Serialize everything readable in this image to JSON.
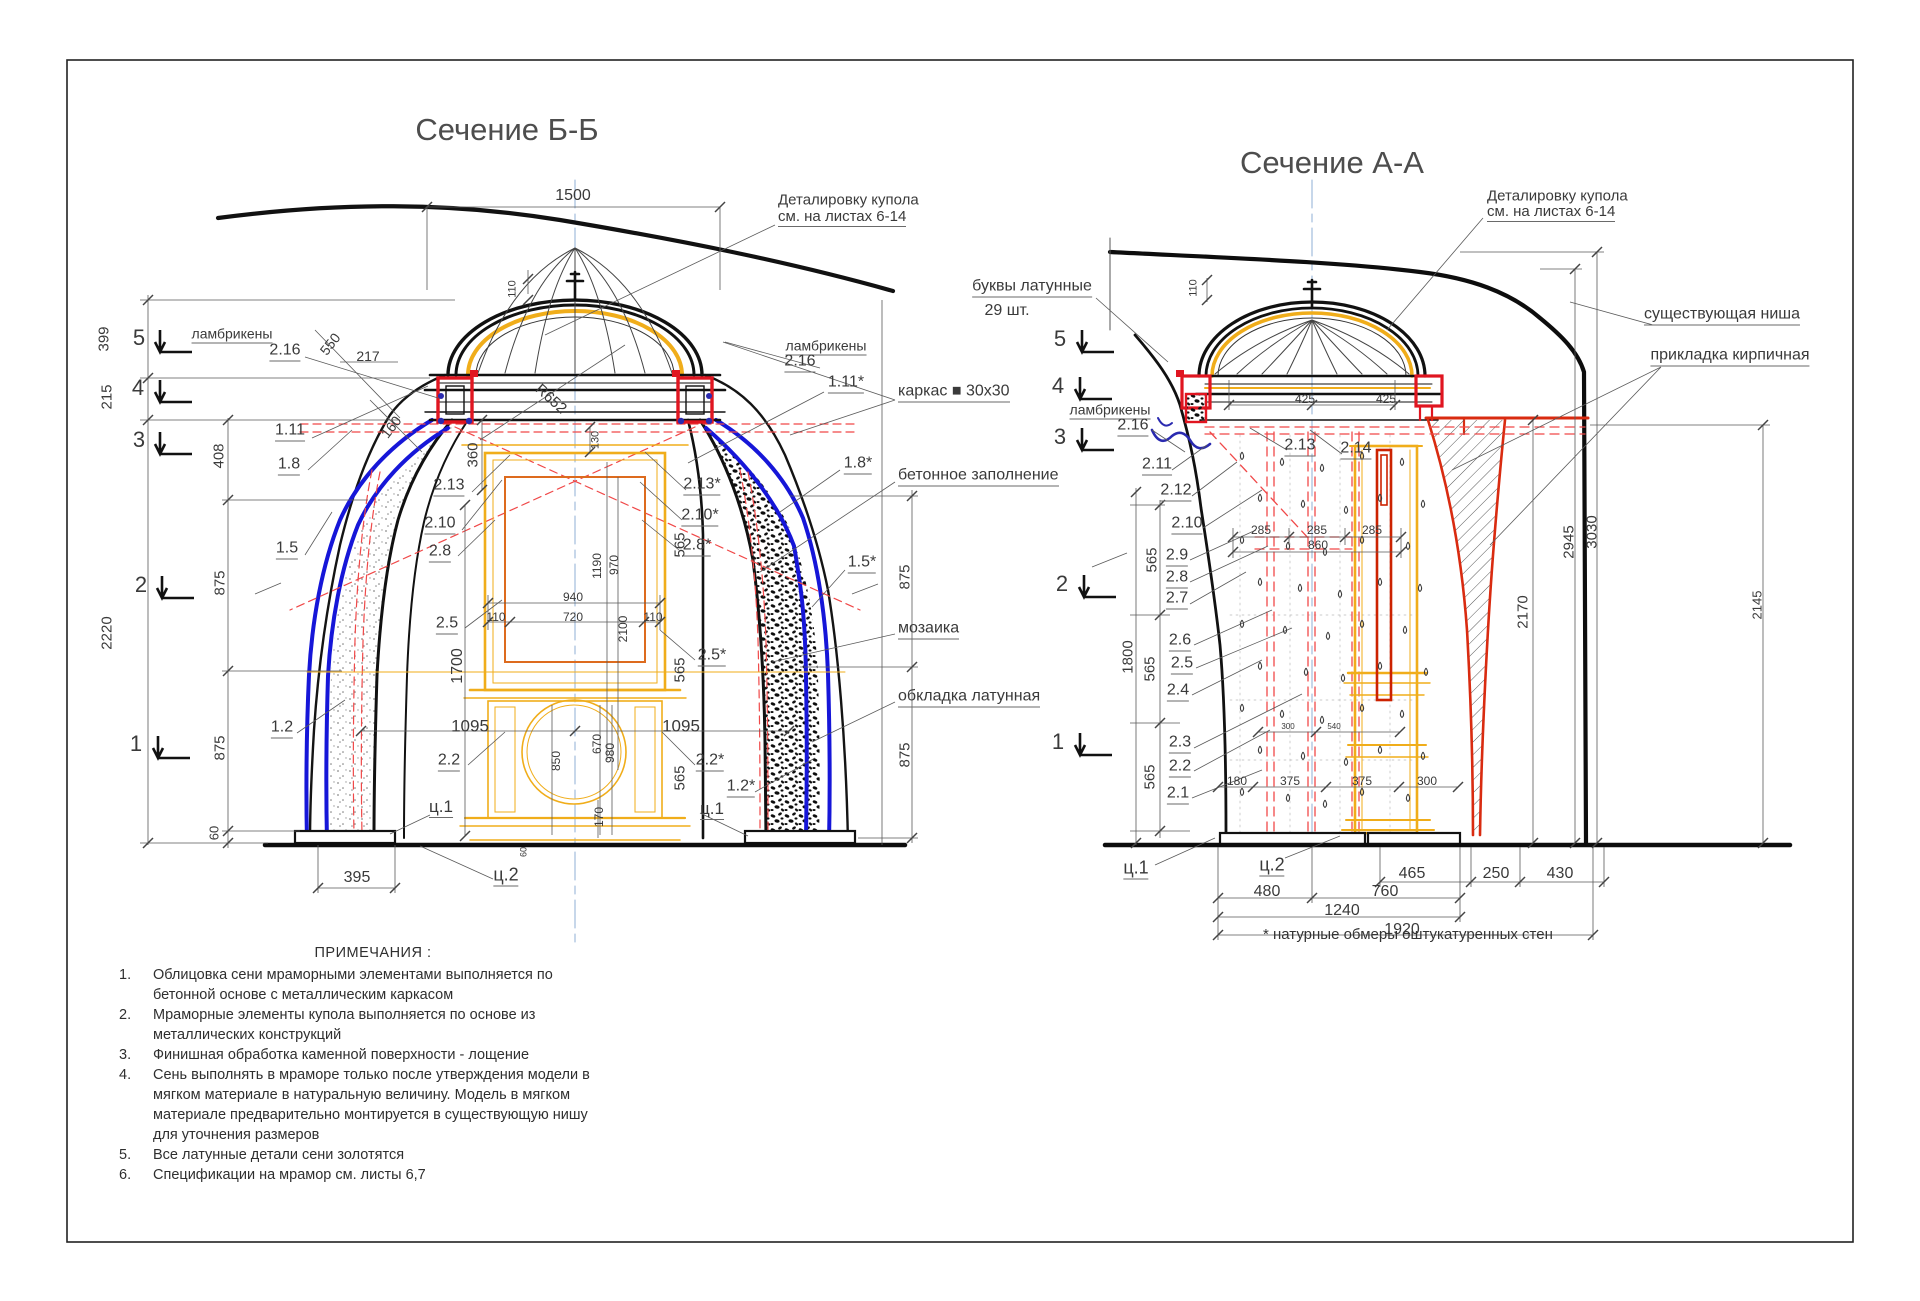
{
  "sheet": {
    "left_title": "Сечение Б-Б",
    "right_title": "Сечение А-А",
    "footnote": "* натурные обмеры оштукатуренных стен"
  },
  "colors": {
    "line": "#1b1b1b",
    "dim_line": "#555555",
    "text": "#3a3a3a",
    "frame_blue": "#1616d8",
    "detail_red": "#e01520",
    "dash_red": "#f04848",
    "gold": "#f0ad1a",
    "orange": "#dd6b1e",
    "brick_red": "#d92b10",
    "axis_blue": "#8fafd6"
  },
  "left_section": {
    "labels": [
      {
        "t": "1500",
        "x": 573,
        "y": 196,
        "s": 16
      },
      {
        "t": "Деталировку купола",
        "x": 778,
        "y": 200,
        "s": 15,
        "a": "start",
        "n": "callout-dome-detail"
      },
      {
        "t": "см. на листах 6-14",
        "x": 778,
        "y": 218,
        "s": 15,
        "a": "start",
        "u": true,
        "n": "callout-dome-detail"
      },
      {
        "t": "110",
        "x": 513,
        "y": 289,
        "r": -90,
        "s": 11
      },
      {
        "t": "ламбрикены",
        "x": 232,
        "y": 335,
        "s": 14,
        "u": true,
        "n": "callout-lambrequins"
      },
      {
        "t": "2.16",
        "x": 285,
        "y": 352,
        "s": 16,
        "u": true
      },
      {
        "t": "550",
        "x": 330,
        "y": 344,
        "r": -52,
        "s": 14
      },
      {
        "t": "217",
        "x": 368,
        "y": 356,
        "s": 14
      },
      {
        "t": "160",
        "x": 391,
        "y": 427,
        "r": -52,
        "s": 14
      },
      {
        "t": "5",
        "x": 139,
        "y": 338,
        "s": 22,
        "n": "level-mark"
      },
      {
        "t": "4",
        "x": 138,
        "y": 388,
        "s": 22,
        "n": "level-mark"
      },
      {
        "t": "3",
        "x": 139,
        "y": 440,
        "s": 22,
        "n": "level-mark"
      },
      {
        "t": "2",
        "x": 141,
        "y": 585,
        "s": 22,
        "n": "level-mark"
      },
      {
        "t": "1",
        "x": 136,
        "y": 744,
        "s": 22,
        "n": "level-mark"
      },
      {
        "t": "399",
        "x": 104,
        "y": 339,
        "r": -90,
        "s": 15
      },
      {
        "t": "215",
        "x": 107,
        "y": 397,
        "r": -90,
        "s": 15
      },
      {
        "t": "2220",
        "x": 107,
        "y": 633,
        "r": -90,
        "s": 15
      },
      {
        "t": "408",
        "x": 219,
        "y": 456,
        "r": -90,
        "s": 15
      },
      {
        "t": "875",
        "x": 220,
        "y": 583,
        "r": -90,
        "s": 15
      },
      {
        "t": "875",
        "x": 220,
        "y": 748,
        "r": -90,
        "s": 15
      },
      {
        "t": "60",
        "x": 214,
        "y": 833,
        "r": -90,
        "s": 13
      },
      {
        "t": "1.11",
        "x": 290,
        "y": 432,
        "s": 16,
        "u": true
      },
      {
        "t": "1.8",
        "x": 289,
        "y": 466,
        "s": 16,
        "u": true
      },
      {
        "t": "1.5",
        "x": 287,
        "y": 550,
        "s": 16,
        "u": true
      },
      {
        "t": "1.2",
        "x": 282,
        "y": 729,
        "s": 16,
        "u": true
      },
      {
        "t": "2.13",
        "x": 449,
        "y": 487,
        "s": 16,
        "u": true
      },
      {
        "t": "2.10",
        "x": 440,
        "y": 525,
        "s": 16,
        "u": true
      },
      {
        "t": "2.8",
        "x": 440,
        "y": 553,
        "s": 16,
        "u": true
      },
      {
        "t": "2.5",
        "x": 447,
        "y": 625,
        "s": 16,
        "u": true
      },
      {
        "t": "2.2",
        "x": 449,
        "y": 762,
        "s": 16,
        "u": true
      },
      {
        "t": "ц.1",
        "x": 441,
        "y": 808,
        "s": 17,
        "u": true
      },
      {
        "t": "ц.2",
        "x": 506,
        "y": 876,
        "s": 18,
        "u": true
      },
      {
        "t": "395",
        "x": 357,
        "y": 878,
        "s": 16
      },
      {
        "t": "R652",
        "x": 551,
        "y": 399,
        "r": 42,
        "s": 15
      },
      {
        "t": "360",
        "x": 473,
        "y": 455,
        "r": -90,
        "s": 15
      },
      {
        "t": "130",
        "x": 596,
        "y": 440,
        "r": -90,
        "s": 11
      },
      {
        "t": "1190",
        "x": 597,
        "y": 566,
        "r": -90,
        "s": 12
      },
      {
        "t": "970",
        "x": 614,
        "y": 565,
        "r": -90,
        "s": 12
      },
      {
        "t": "2100",
        "x": 623,
        "y": 629,
        "r": -90,
        "s": 12
      },
      {
        "t": "940",
        "x": 573,
        "y": 597,
        "s": 12
      },
      {
        "t": "110",
        "x": 496,
        "y": 617,
        "s": 12
      },
      {
        "t": "720",
        "x": 573,
        "y": 617,
        "s": 12
      },
      {
        "t": "110",
        "x": 653,
        "y": 617,
        "s": 12
      },
      {
        "t": "1700",
        "x": 458,
        "y": 666,
        "r": -90,
        "s": 16
      },
      {
        "t": "1095",
        "x": 470,
        "y": 726,
        "s": 17
      },
      {
        "t": "1095",
        "x": 681,
        "y": 726,
        "s": 17
      },
      {
        "t": "850",
        "x": 556,
        "y": 761,
        "r": -90,
        "s": 12
      },
      {
        "t": "670",
        "x": 597,
        "y": 744,
        "r": -90,
        "s": 12
      },
      {
        "t": "980",
        "x": 610,
        "y": 753,
        "r": -90,
        "s": 12
      },
      {
        "t": "170",
        "x": 599,
        "y": 817,
        "r": -90,
        "s": 12
      },
      {
        "t": "60",
        "x": 524,
        "y": 852,
        "r": -90,
        "s": 9
      },
      {
        "t": "565",
        "x": 680,
        "y": 545,
        "r": -90,
        "s": 15
      },
      {
        "t": "565",
        "x": 680,
        "y": 670,
        "r": -90,
        "s": 15
      },
      {
        "t": "565",
        "x": 680,
        "y": 778,
        "r": -90,
        "s": 15
      },
      {
        "t": "2.13*",
        "x": 702,
        "y": 486,
        "s": 16,
        "u": true
      },
      {
        "t": "2.10*",
        "x": 700,
        "y": 517,
        "s": 16,
        "u": true
      },
      {
        "t": "2.8*",
        "x": 697,
        "y": 547,
        "s": 16,
        "u": true
      },
      {
        "t": "2.5*",
        "x": 712,
        "y": 657,
        "s": 16,
        "u": true
      },
      {
        "t": "2.2*",
        "x": 710,
        "y": 762,
        "s": 16,
        "u": true
      },
      {
        "t": "ц.1",
        "x": 712,
        "y": 810,
        "s": 17,
        "u": true
      },
      {
        "t": "1.2*",
        "x": 741,
        "y": 788,
        "s": 16,
        "u": true
      },
      {
        "t": "ламбрикены",
        "x": 826,
        "y": 347,
        "s": 14,
        "u": true,
        "n": "callout-lambrequins"
      },
      {
        "t": "2.16",
        "x": 800,
        "y": 363,
        "s": 16,
        "u": true
      },
      {
        "t": "1.11*",
        "x": 846,
        "y": 384,
        "s": 16,
        "u": true
      },
      {
        "t": "1.8*",
        "x": 858,
        "y": 465,
        "s": 16,
        "u": true
      },
      {
        "t": "1.5*",
        "x": 862,
        "y": 564,
        "s": 16,
        "u": true
      },
      {
        "t": "каркас  ■  30х30",
        "x": 898,
        "y": 393,
        "s": 16,
        "a": "start",
        "u": true,
        "n": "callout-frame"
      },
      {
        "t": "бетонное заполнение",
        "x": 898,
        "y": 477,
        "s": 16,
        "a": "start",
        "u": true,
        "n": "callout-concrete"
      },
      {
        "t": "мозаика",
        "x": 898,
        "y": 630,
        "s": 16,
        "a": "start",
        "u": true,
        "n": "callout-mosaic"
      },
      {
        "t": "обкладка латунная",
        "x": 898,
        "y": 698,
        "s": 16,
        "a": "start",
        "u": true,
        "n": "callout-brass"
      },
      {
        "t": "875",
        "x": 905,
        "y": 577,
        "r": -90,
        "s": 15
      },
      {
        "t": "875",
        "x": 905,
        "y": 755,
        "r": -90,
        "s": 15
      }
    ]
  },
  "right_section": {
    "labels": [
      {
        "t": "Деталировку купола",
        "x": 1487,
        "y": 196,
        "s": 15,
        "a": "start",
        "n": "callout-dome-detail"
      },
      {
        "t": "см. на листах 6-14",
        "x": 1487,
        "y": 213,
        "s": 15,
        "a": "start",
        "u": true,
        "n": "callout-dome-detail"
      },
      {
        "t": "буквы латунные",
        "x": 1032,
        "y": 288,
        "s": 16,
        "u": true,
        "n": "callout-brass-letters"
      },
      {
        "t": "29 шт.",
        "x": 1007,
        "y": 311,
        "s": 16,
        "n": "callout-brass-letters-qty"
      },
      {
        "t": "110",
        "x": 1194,
        "y": 288,
        "r": -90,
        "s": 11
      },
      {
        "t": "425",
        "x": 1305,
        "y": 399,
        "s": 12
      },
      {
        "t": "425",
        "x": 1386,
        "y": 399,
        "s": 12
      },
      {
        "t": "существующая ниша",
        "x": 1722,
        "y": 316,
        "s": 16,
        "u": true,
        "n": "callout-existing-niche"
      },
      {
        "t": "прикладка кирпичная",
        "x": 1730,
        "y": 357,
        "s": 16,
        "u": true,
        "n": "callout-brickwork"
      },
      {
        "t": "5",
        "x": 1060,
        "y": 339,
        "s": 22,
        "n": "level-mark"
      },
      {
        "t": "4",
        "x": 1058,
        "y": 386,
        "s": 22,
        "n": "level-mark"
      },
      {
        "t": "3",
        "x": 1060,
        "y": 437,
        "s": 22,
        "n": "level-mark"
      },
      {
        "t": "2",
        "x": 1062,
        "y": 584,
        "s": 22,
        "n": "level-mark"
      },
      {
        "t": "1",
        "x": 1058,
        "y": 742,
        "s": 22,
        "n": "level-mark"
      },
      {
        "t": "ламбрикены",
        "x": 1110,
        "y": 411,
        "s": 14,
        "u": true,
        "n": "callout-lambrequins"
      },
      {
        "t": "2.16",
        "x": 1133,
        "y": 427,
        "s": 16,
        "u": true
      },
      {
        "t": "2.11",
        "x": 1157,
        "y": 466,
        "s": 16,
        "u": true
      },
      {
        "t": "2.12",
        "x": 1176,
        "y": 492,
        "s": 16,
        "u": true
      },
      {
        "t": "2.10",
        "x": 1187,
        "y": 525,
        "s": 16,
        "u": true
      },
      {
        "t": "2.9",
        "x": 1177,
        "y": 557,
        "s": 16,
        "u": true
      },
      {
        "t": "2.8",
        "x": 1177,
        "y": 579,
        "s": 16,
        "u": true
      },
      {
        "t": "2.7",
        "x": 1177,
        "y": 600,
        "s": 16,
        "u": true
      },
      {
        "t": "2.6",
        "x": 1180,
        "y": 642,
        "s": 16,
        "u": true
      },
      {
        "t": "2.5",
        "x": 1182,
        "y": 665,
        "s": 16,
        "u": true
      },
      {
        "t": "2.4",
        "x": 1178,
        "y": 692,
        "s": 16,
        "u": true
      },
      {
        "t": "2.3",
        "x": 1180,
        "y": 744,
        "s": 16,
        "u": true
      },
      {
        "t": "2.2",
        "x": 1180,
        "y": 768,
        "s": 16,
        "u": true
      },
      {
        "t": "2.1",
        "x": 1178,
        "y": 795,
        "s": 16,
        "u": true
      },
      {
        "t": "2.13",
        "x": 1300,
        "y": 447,
        "s": 16,
        "u": true
      },
      {
        "t": "2.14",
        "x": 1356,
        "y": 450,
        "s": 16,
        "u": true
      },
      {
        "t": "285",
        "x": 1261,
        "y": 530,
        "s": 12
      },
      {
        "t": "285",
        "x": 1317,
        "y": 530,
        "s": 12
      },
      {
        "t": "285",
        "x": 1372,
        "y": 530,
        "s": 12
      },
      {
        "t": "860",
        "x": 1318,
        "y": 545,
        "s": 12
      },
      {
        "t": "565",
        "x": 1152,
        "y": 560,
        "r": -90,
        "s": 15
      },
      {
        "t": "565",
        "x": 1150,
        "y": 669,
        "r": -90,
        "s": 15
      },
      {
        "t": "565",
        "x": 1150,
        "y": 777,
        "r": -90,
        "s": 15
      },
      {
        "t": "1800",
        "x": 1128,
        "y": 657,
        "r": -90,
        "s": 15
      },
      {
        "t": "180",
        "x": 1237,
        "y": 781,
        "s": 12
      },
      {
        "t": "375",
        "x": 1290,
        "y": 781,
        "s": 12
      },
      {
        "t": "375",
        "x": 1362,
        "y": 781,
        "s": 12
      },
      {
        "t": "300",
        "x": 1427,
        "y": 781,
        "s": 12
      },
      {
        "t": "300",
        "x": 1288,
        "y": 727,
        "s": 8
      },
      {
        "t": "540",
        "x": 1334,
        "y": 727,
        "s": 8
      },
      {
        "t": "ц.1",
        "x": 1136,
        "y": 869,
        "s": 18,
        "u": true
      },
      {
        "t": "ц.2",
        "x": 1272,
        "y": 866,
        "s": 18,
        "u": true
      },
      {
        "t": "480",
        "x": 1267,
        "y": 892,
        "s": 16
      },
      {
        "t": "465",
        "x": 1412,
        "y": 874,
        "s": 16
      },
      {
        "t": "760",
        "x": 1385,
        "y": 892,
        "s": 16
      },
      {
        "t": "1240",
        "x": 1342,
        "y": 911,
        "s": 16
      },
      {
        "t": "1920",
        "x": 1402,
        "y": 930,
        "s": 16
      },
      {
        "t": "250",
        "x": 1496,
        "y": 874,
        "s": 16
      },
      {
        "t": "430",
        "x": 1560,
        "y": 874,
        "s": 16
      },
      {
        "t": "2170",
        "x": 1523,
        "y": 612,
        "r": -90,
        "s": 15
      },
      {
        "t": "2945",
        "x": 1569,
        "y": 542,
        "r": -90,
        "s": 15
      },
      {
        "t": "3030",
        "x": 1592,
        "y": 532,
        "r": -90,
        "s": 15
      },
      {
        "t": "2145",
        "x": 1757,
        "y": 605,
        "r": -90,
        "s": 13
      }
    ]
  },
  "notes": {
    "title": "ПРИМЕЧАНИЯ :",
    "items": [
      {
        "num": "1.",
        "text": "Облицовка сени мраморными элементами выполняется по бетонной основе с металлическим каркасом"
      },
      {
        "num": "2.",
        "text": "Мраморные элементы купола выполняется по основе из металлических конструкций"
      },
      {
        "num": "3.",
        "text": "Финишная обработка каменной поверхности  - лощение"
      },
      {
        "num": "4.",
        "text": "Сень выполнять в мраморе только после утверждения модели в мягком материале в натуральную величину. Модель в мягком материале предварительно монтируется в существующую нишу для уточнения размеров"
      },
      {
        "num": "5.",
        "text": "Все латунные детали сени золотятся"
      },
      {
        "num": "6.",
        "text": "Спецификации на мрамор см. листы 6,7"
      }
    ]
  }
}
